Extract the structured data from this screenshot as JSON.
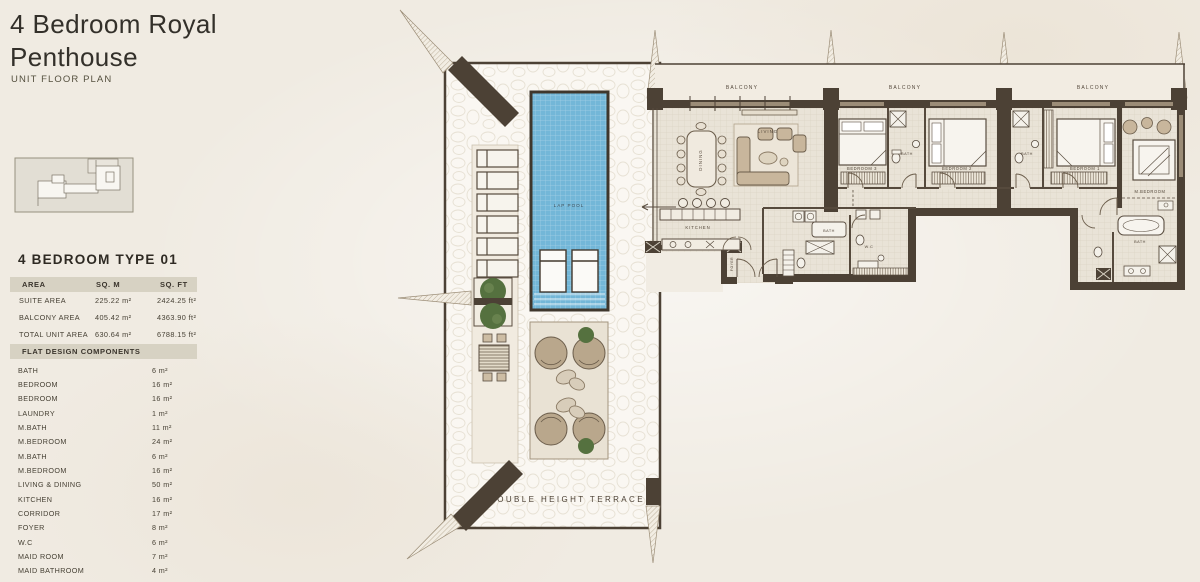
{
  "page": {
    "title_line1": "4 Bedroom Royal",
    "title_line2": "Penthouse",
    "subtitle": "UNIT FLOOR PLAN"
  },
  "unit_info": {
    "type_title": "4 BEDROOM TYPE 01",
    "area_table": {
      "headers": [
        "AREA",
        "SQ. M",
        "SQ. FT"
      ],
      "rows": [
        {
          "label": "SUITE AREA",
          "sqm": "225.22 m²",
          "sqft": "2424.25 ft²"
        },
        {
          "label": "BALCONY AREA",
          "sqm": "405.42 m²",
          "sqft": "4363.90 ft²"
        },
        {
          "label": "TOTAL UNIT AREA",
          "sqm": "630.64 m²",
          "sqft": "6788.15 ft²"
        }
      ]
    },
    "components_title": "FLAT DESIGN COMPONENTS",
    "components": [
      {
        "label": "BATH",
        "area": "6 m²"
      },
      {
        "label": "BEDROOM",
        "area": "16 m²"
      },
      {
        "label": "BEDROOM",
        "area": "16 m²"
      },
      {
        "label": "LAUNDRY",
        "area": "1 m²"
      },
      {
        "label": "M.BATH",
        "area": "11 m²"
      },
      {
        "label": "M.BEDROOM",
        "area": "24 m²"
      },
      {
        "label": "M.BATH",
        "area": "6 m²"
      },
      {
        "label": "M.BEDROOM",
        "area": "16 m²"
      },
      {
        "label": "LIVING & DINING",
        "area": "50 m²"
      },
      {
        "label": "KITCHEN",
        "area": "16 m²"
      },
      {
        "label": "CORRIDOR",
        "area": "17 m²"
      },
      {
        "label": "FOYER",
        "area": "8 m²"
      },
      {
        "label": "W.C",
        "area": "6 m²"
      },
      {
        "label": "MAID ROOM",
        "area": "7 m²"
      },
      {
        "label": "MAID BATHROOM",
        "area": "4 m²"
      }
    ]
  },
  "plan": {
    "labels": {
      "balcony": "BALCONY",
      "dining": "DINING",
      "living": "LIVING",
      "bedroom3": "BEDROOM 3",
      "bedroom2": "BEDROOM 2",
      "bedroom1": "BEDROOM 1",
      "mbedroom": "M.BEDROOM",
      "bath_bedroom3": "BATH",
      "bath_bedroom2": "BATH",
      "bath_master": "BATH",
      "bath_mid": "BATH",
      "wc": "W.C",
      "kitchen": "KITCHEN",
      "foyer": "FOYER",
      "lap_pool": "LAP POOL",
      "terrace": "DOUBLE HEIGHT TERRACE"
    },
    "colors": {
      "wall": "#4c4135",
      "pool": "#73b7d8",
      "tile": "#e9e3d7",
      "terrace": "#faf7f2",
      "accent_green": "#55713f"
    }
  }
}
